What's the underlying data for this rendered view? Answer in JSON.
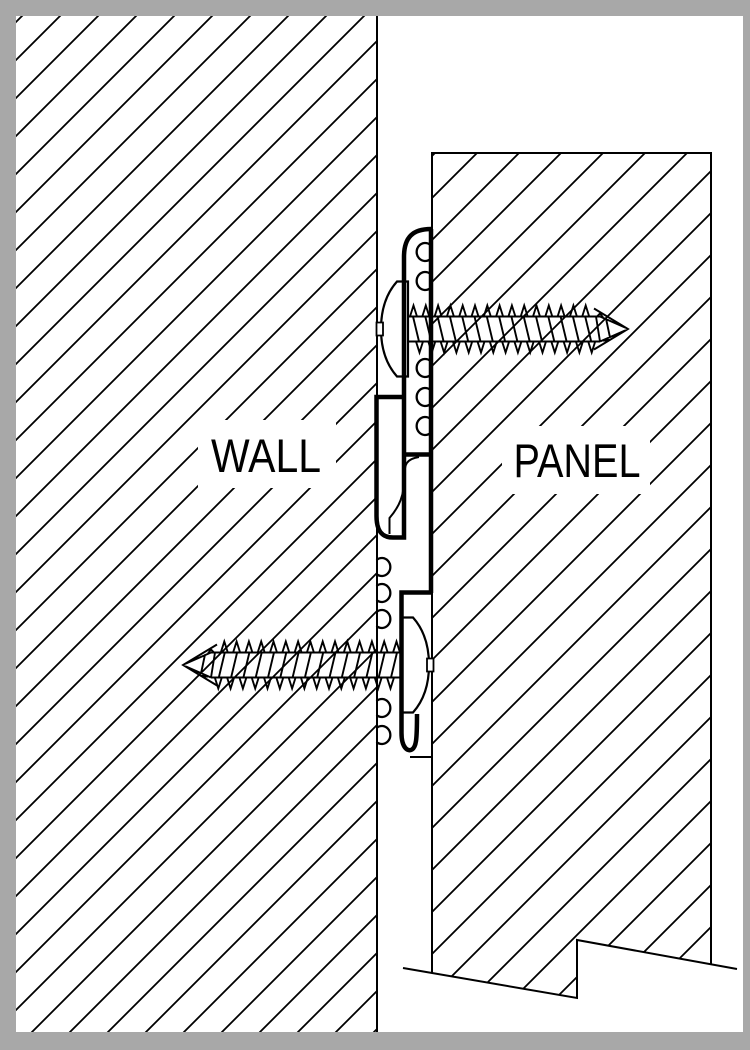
{
  "labels": {
    "wall": "WALL",
    "panel": "PANEL"
  },
  "colors": {
    "line": "#000000",
    "canvas": "#ffffff",
    "border": "#a8a8a8"
  },
  "drawing": {
    "type": "technical-section-detail",
    "components": [
      "wall",
      "panel",
      "upper-z-clip",
      "lower-z-clip",
      "panel-screw",
      "wall-screw"
    ]
  }
}
